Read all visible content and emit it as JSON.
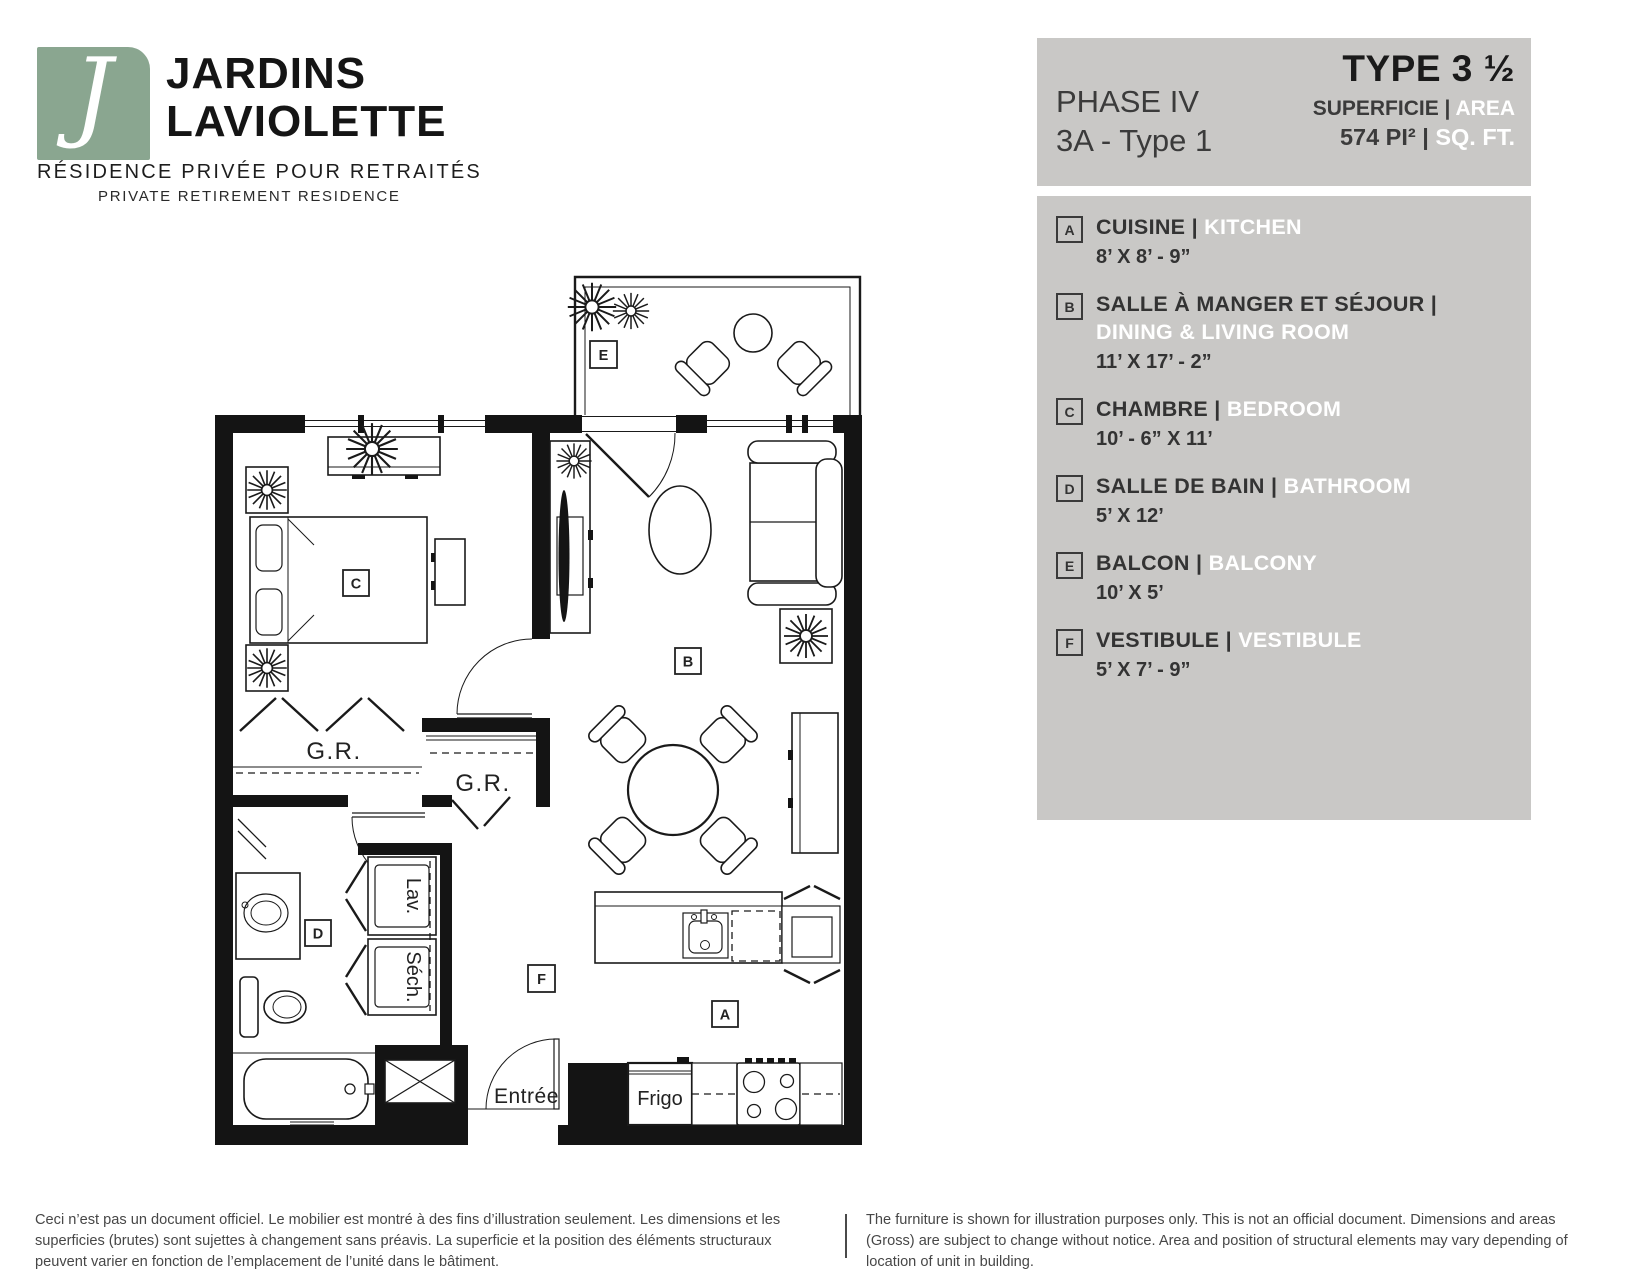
{
  "logo": {
    "monogram": "J",
    "name_line1": "JARDINS",
    "name_line2": "LAVIOLETTE",
    "tagline_fr": "RÉSIDENCE PRIVÉE POUR RETRAITÉS",
    "tagline_en": "PRIVATE RETIREMENT RESIDENCE",
    "brand_color": "#8aa690"
  },
  "header": {
    "phase": "PHASE IV",
    "unit": "3A - Type 1",
    "type": "TYPE 3 ½",
    "area_label_fr": "SUPERFICIE |",
    "area_label_en": "AREA",
    "area_value_fr": "574 PI² |",
    "area_value_en": "SQ. FT.",
    "panel_color": "#c9c8c6"
  },
  "legend": {
    "items": [
      {
        "letter": "A",
        "name_fr": "CUISINE |",
        "name_en": "KITCHEN",
        "stacked": false,
        "dimensions": "8’ X 8’ - 9”"
      },
      {
        "letter": "B",
        "name_fr": "SALLE À MANGER ET SÉJOUR |",
        "name_en": "DINING & LIVING ROOM",
        "stacked": true,
        "dimensions": "11’ X 17’ - 2”"
      },
      {
        "letter": "C",
        "name_fr": "CHAMBRE |",
        "name_en": "BEDROOM",
        "stacked": false,
        "dimensions": "10’ - 6” X 11’"
      },
      {
        "letter": "D",
        "name_fr": "SALLE DE BAIN |",
        "name_en": "BATHROOM",
        "stacked": false,
        "dimensions": "5’ X 12’"
      },
      {
        "letter": "E",
        "name_fr": "BALCON |",
        "name_en": "BALCONY",
        "stacked": false,
        "dimensions": "10’ X 5’"
      },
      {
        "letter": "F",
        "name_fr": "VESTIBULE |",
        "name_en": "VESTIBULE",
        "stacked": false,
        "dimensions": "5’ X 7’ - 9”"
      }
    ]
  },
  "floorplan": {
    "labels": {
      "a": "A",
      "b": "B",
      "c": "C",
      "d": "D",
      "e": "E",
      "f": "F"
    },
    "closet_label": "G.R.",
    "closet_label_2": "G.R.",
    "washer_label": "Lav.",
    "dryer_label": "Séch.",
    "entrance_label": "Entrée",
    "fridge_label": "Frigo"
  },
  "footer": {
    "disclaimer_fr": "Ceci n’est pas un document officiel. Le mobilier est montré à des fins d’illustration seulement. Les dimensions et les superficies (brutes) sont sujettes à changement sans préavis. La superficie et la position des éléments structuraux peuvent varier en fonction de l’emplacement de l’unité dans le bâtiment.",
    "disclaimer_en": "The furniture is shown for illustration purposes only. This is not an official document. Dimensions and areas (Gross) are subject to change without notice. Area and position of structural elements may vary depending of location of unit in building."
  }
}
